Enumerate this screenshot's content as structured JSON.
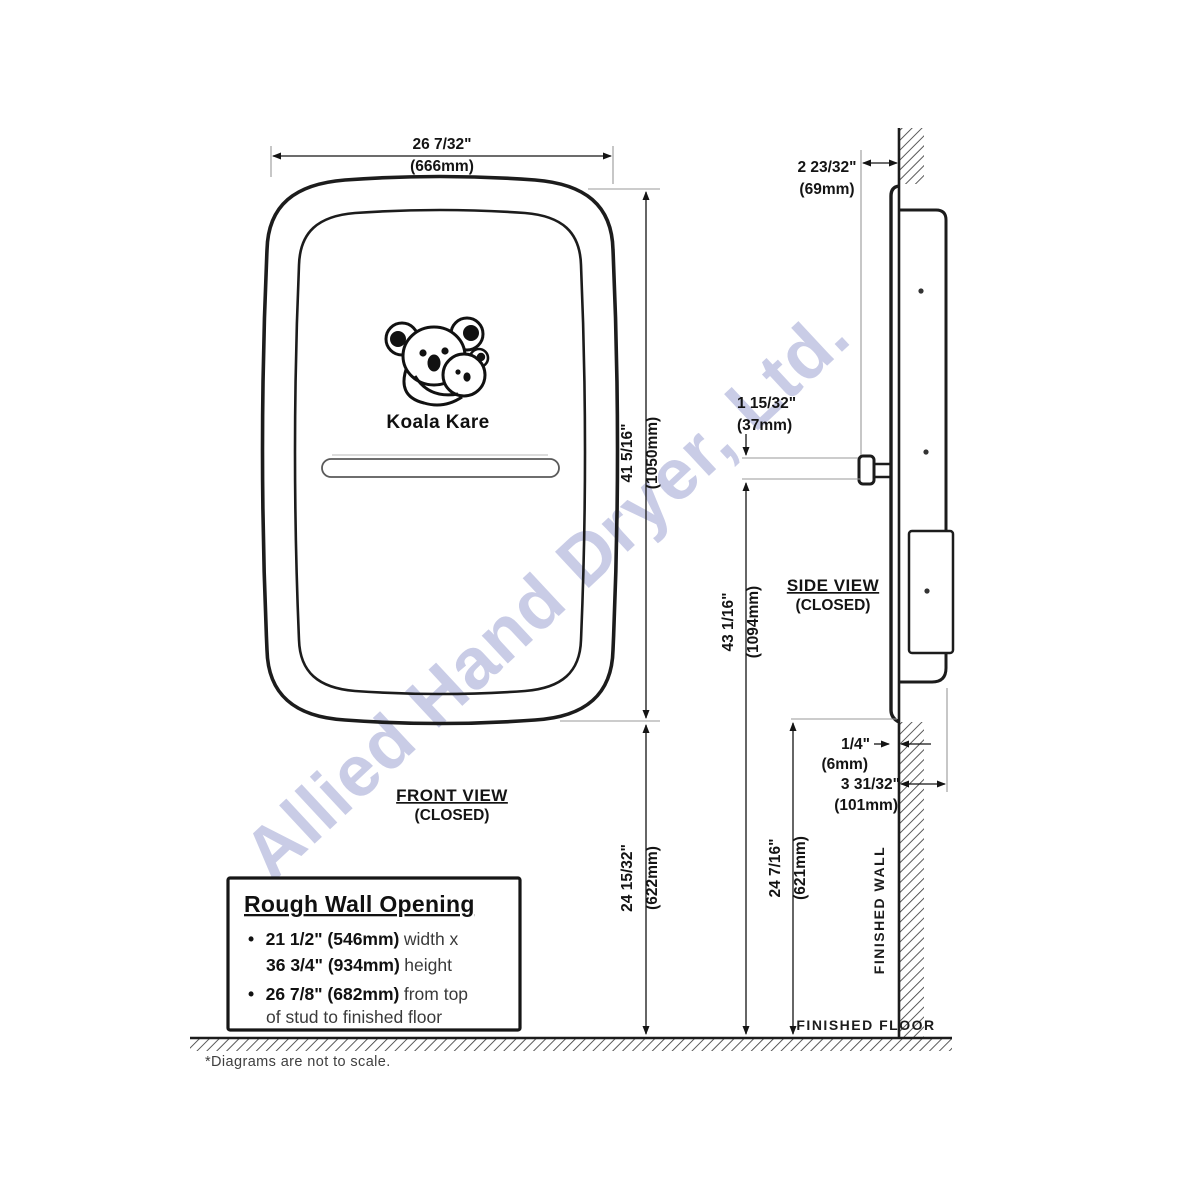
{
  "watermark": {
    "text": "Allied Hand Dryer, Ltd.",
    "color": "#a9aed8"
  },
  "front_view": {
    "title": "FRONT VIEW",
    "subtitle": "(CLOSED)",
    "brand": "Koala Kare",
    "dim_width_in": "26 7/32\"",
    "dim_width_mm": "(666mm)",
    "dim_height_in": "41 5/16\"",
    "dim_height_mm": "(1050mm)",
    "dim_to_floor_in": "24 15/32\"",
    "dim_to_floor_mm": "(622mm)"
  },
  "side_view": {
    "title": "SIDE VIEW",
    "subtitle": "(CLOSED)",
    "dim_protrusion_in": "2 23/32\"",
    "dim_protrusion_mm": "(69mm)",
    "dim_knob_in": "1 15/32\"",
    "dim_knob_mm": "(37mm)",
    "dim_knob_to_floor_in": "43 1/16\"",
    "dim_knob_to_floor_mm": "(1094mm)",
    "dim_lip_in": "1/4\"",
    "dim_lip_mm": "(6mm)",
    "dim_recess_in": "3 31/32\"",
    "dim_recess_mm": "(101mm)",
    "dim_bottom_to_floor_in": "24 7/16\"",
    "dim_bottom_to_floor_mm": "(621mm)",
    "wall_label": "FINISHED WALL",
    "floor_label": "FINISHED FLOOR"
  },
  "rough_wall_opening": {
    "title": "Rough Wall Opening",
    "bullet": "•",
    "b1_bold1": "21 1/2\" (546mm)",
    "b1_text1": " width x",
    "b1_bold2": "36 3/4\" (934mm)",
    "b1_text2": " height",
    "b2_bold": "26 7/8\" (682mm)",
    "b2_text": " from top",
    "b2_line2": "of stud to finished floor"
  },
  "footnote": "*Diagrams are not to scale."
}
